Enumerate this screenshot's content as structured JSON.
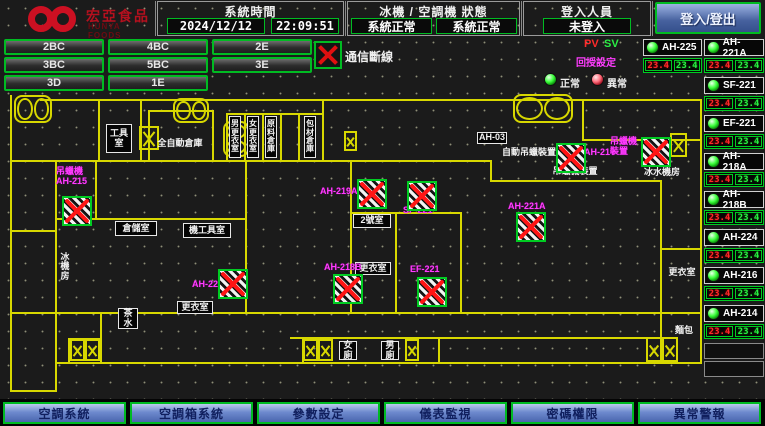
{
  "header": {
    "logo_title": "宏亞食品",
    "logo_subtitle": "HUNYA FOODS",
    "system_time_label": "系統時間",
    "date": "2024/12/12",
    "time": "22:09:51",
    "status_label": "冰機 / 空調機 狀態",
    "status1": "系統正常",
    "status2": "系統正常",
    "login_label": "登入人員",
    "login_status": "未登入",
    "login_button": "登入/登出"
  },
  "floor_buttons": [
    [
      "2BC",
      "4BC",
      "2E"
    ],
    [
      "3BC",
      "5BC",
      "3E"
    ],
    [
      "3D",
      "1E"
    ]
  ],
  "comm": {
    "label": "通信斷線"
  },
  "legend": {
    "pv": "PV",
    "sv": "SV",
    "pv_sv_caption": "回授設定",
    "normal": "正常",
    "abnormal": "異常"
  },
  "right_panel": {
    "devices": [
      {
        "name": "AH-225",
        "pv": "23.4",
        "sv": "23.4",
        "col": 0,
        "slot": 0
      },
      {
        "name": "AH-221A",
        "pv": "23.4",
        "sv": "23.4",
        "col": 1,
        "slot": 0
      },
      {
        "name": "SF-221",
        "pv": "23.4",
        "sv": "23.4",
        "col": 1,
        "slot": 1
      },
      {
        "name": "EF-221",
        "pv": "23.4",
        "sv": "23.4",
        "col": 1,
        "slot": 2
      },
      {
        "name": "AH-218A",
        "pv": "23.4",
        "sv": "23.4",
        "col": 1,
        "slot": 3
      },
      {
        "name": "AH-218B",
        "pv": "23.4",
        "sv": "23.4",
        "col": 1,
        "slot": 4
      },
      {
        "name": "AH-224",
        "pv": "23.4",
        "sv": "23.4",
        "col": 1,
        "slot": 5
      },
      {
        "name": "AH-216",
        "pv": "23.4",
        "sv": "23.4",
        "col": 1,
        "slot": 6
      },
      {
        "name": "AH-214",
        "pv": "23.4",
        "sv": "23.4",
        "col": 1,
        "slot": 7
      }
    ],
    "empty_slots": 2
  },
  "plan": {
    "rooms": [
      {
        "t": "工具\n室",
        "x": 106,
        "y": 124,
        "w": 26,
        "h": 29,
        "boxed": true
      },
      {
        "t": "全自動倉庫",
        "x": 152,
        "y": 137,
        "w": 56,
        "h": 13
      },
      {
        "t": "男更衣室",
        "x": 229,
        "y": 116,
        "w": 12,
        "h": 42,
        "boxed": true,
        "vert": true
      },
      {
        "t": "女更衣室",
        "x": 247,
        "y": 116,
        "w": 12,
        "h": 42,
        "boxed": true,
        "vert": true
      },
      {
        "t": "原料倉庫",
        "x": 265,
        "y": 116,
        "w": 12,
        "h": 42,
        "boxed": true,
        "vert": true
      },
      {
        "t": "包材倉庫",
        "x": 304,
        "y": 116,
        "w": 12,
        "h": 42,
        "boxed": true,
        "vert": true
      },
      {
        "t": "倉儲室",
        "x": 115,
        "y": 221,
        "w": 42,
        "h": 15,
        "boxed": true
      },
      {
        "t": "機工具室",
        "x": 183,
        "y": 223,
        "w": 48,
        "h": 15,
        "boxed": true
      },
      {
        "t": "冰\n機\n房",
        "x": 56,
        "y": 246,
        "w": 18,
        "h": 42
      },
      {
        "t": "2號室",
        "x": 353,
        "y": 214,
        "w": 38,
        "h": 14,
        "boxed": true
      },
      {
        "t": "更衣室",
        "x": 355,
        "y": 262,
        "w": 36,
        "h": 13,
        "boxed": true
      },
      {
        "t": "更衣室",
        "x": 177,
        "y": 301,
        "w": 36,
        "h": 13,
        "boxed": true
      },
      {
        "t": "AH-03",
        "x": 477,
        "y": 132,
        "w": 30,
        "h": 12,
        "boxed": true
      },
      {
        "t": "自動吊蠟裝置",
        "x": 501,
        "y": 147,
        "w": 56,
        "h": 11
      },
      {
        "t": "吊蠟機裝置",
        "x": 551,
        "y": 166,
        "w": 48,
        "h": 11
      },
      {
        "t": "冰水機房",
        "x": 643,
        "y": 167,
        "w": 38,
        "h": 11
      },
      {
        "t": "茶\n水",
        "x": 118,
        "y": 308,
        "w": 20,
        "h": 21,
        "boxed": true
      },
      {
        "t": "女廁",
        "x": 339,
        "y": 341,
        "w": 18,
        "h": 19,
        "boxed": true
      },
      {
        "t": "男廁",
        "x": 381,
        "y": 341,
        "w": 18,
        "h": 19,
        "boxed": true
      },
      {
        "t": "更衣室",
        "x": 668,
        "y": 267,
        "w": 28,
        "h": 11
      },
      {
        "t": "麵包",
        "x": 672,
        "y": 325,
        "w": 24,
        "h": 11
      }
    ],
    "device_labels": [
      {
        "t": "吊蠟機\nAH-215",
        "x": 56,
        "y": 167
      },
      {
        "t": "AH-219A",
        "x": 320,
        "y": 187
      },
      {
        "t": "SF-221",
        "x": 403,
        "y": 206
      },
      {
        "t": "AH-221A",
        "x": 508,
        "y": 202
      },
      {
        "t": "AH-214",
        "x": 584,
        "y": 148
      },
      {
        "t": "吊蠟機\n裝置",
        "x": 610,
        "y": 137
      },
      {
        "t": "AH-224",
        "x": 192,
        "y": 280
      },
      {
        "t": "AH-218B",
        "x": 324,
        "y": 263
      },
      {
        "t": "EF-221",
        "x": 410,
        "y": 265
      }
    ],
    "alarm_icons": [
      {
        "x": 62,
        "y": 196
      },
      {
        "x": 357,
        "y": 179
      },
      {
        "x": 407,
        "y": 181
      },
      {
        "x": 516,
        "y": 212
      },
      {
        "x": 556,
        "y": 143
      },
      {
        "x": 641,
        "y": 137
      },
      {
        "x": 218,
        "y": 269
      },
      {
        "x": 333,
        "y": 274
      },
      {
        "x": 417,
        "y": 277
      }
    ],
    "shafts": [
      {
        "x": 139,
        "y": 126,
        "w": 20,
        "h": 24
      },
      {
        "x": 344,
        "y": 131,
        "w": 13,
        "h": 20
      },
      {
        "x": 670,
        "y": 133,
        "w": 17,
        "h": 24
      },
      {
        "x": 70,
        "y": 339,
        "w": 15,
        "h": 22
      },
      {
        "x": 85,
        "y": 339,
        "w": 15,
        "h": 22
      },
      {
        "x": 303,
        "y": 339,
        "w": 15,
        "h": 22
      },
      {
        "x": 318,
        "y": 339,
        "w": 15,
        "h": 22
      },
      {
        "x": 405,
        "y": 339,
        "w": 14,
        "h": 22
      },
      {
        "x": 646,
        "y": 337,
        "w": 16,
        "h": 25
      },
      {
        "x": 662,
        "y": 337,
        "w": 16,
        "h": 25
      }
    ],
    "stairs": [
      {
        "x": 14,
        "y": 95,
        "w": 38,
        "h": 28
      },
      {
        "x": 173,
        "y": 98,
        "w": 36,
        "h": 25
      },
      {
        "x": 513,
        "y": 94,
        "w": 60,
        "h": 29
      },
      {
        "x": 223,
        "y": 121,
        "w": 26,
        "h": 36,
        "v": true
      }
    ]
  },
  "nav": [
    "空調系統",
    "空調箱系統",
    "參數設定",
    "儀表監視",
    "密碼權限",
    "異常警報"
  ],
  "colors": {
    "accent_green": "#00cc22",
    "alarm_red": "#ff1515",
    "magenta": "#ff3cff",
    "wall_yellow": "#d8d800",
    "value_red": "#ff2a2a",
    "value_green": "#2aee44",
    "nav_blue": "#5878c0"
  }
}
